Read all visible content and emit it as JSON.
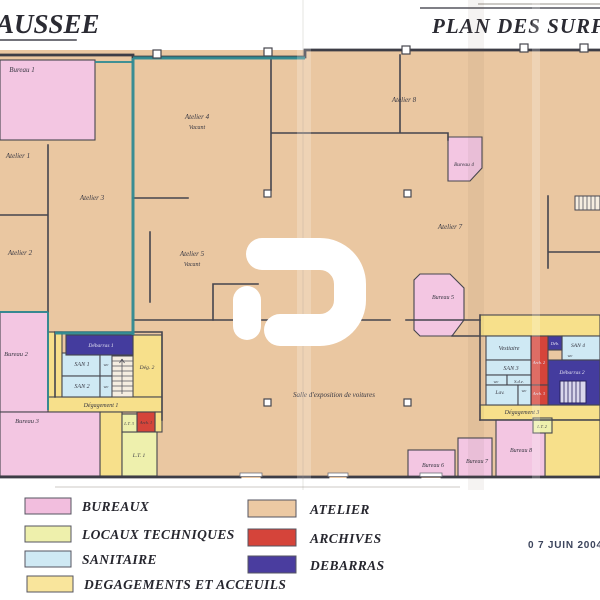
{
  "header": {
    "title_left": "AUSSEE",
    "title_right": "PLAN DES SURFAC"
  },
  "stamp": {
    "date": "0 7 JUIN 2004"
  },
  "legend": {
    "left": [
      {
        "label": "BUREAUX",
        "color": "#f2bede"
      },
      {
        "label": "LOCAUX TECHNIQUES",
        "color": "#eef0ac"
      },
      {
        "label": "SANITAIRE",
        "color": "#cfe9f4"
      },
      {
        "label": "DEGAGEMENTS ET ACCEUILS",
        "color": "#f9e59c"
      }
    ],
    "right": [
      {
        "label": "ATELIER",
        "color": "#ecc9a3"
      },
      {
        "label": "ARCHIVES",
        "color": "#d5443a"
      },
      {
        "label": "DEBARRAS",
        "color": "#4a3d9f"
      }
    ]
  },
  "rooms": {
    "bureau_1": "Bureau 1",
    "bureau_2": "Bureau 2",
    "bureau_3": "Bureau 3",
    "bureau_4": "Bureau 4",
    "bureau_5": "Bureau 5",
    "bureau_6": "Bureau 6",
    "bureau_7": "Bureau 7",
    "bureau_8": "Bureau 8",
    "atelier_1": "Atelier 1",
    "atelier_2": "Atelier 2",
    "atelier_3": "Atelier 3",
    "atelier_4": "Atelier 4",
    "atelier_5": "Atelier 5",
    "atelier_7": "Atelier 7",
    "atelier_8": "Atelier 8",
    "vacant": "Vacant",
    "salle_expo": "Salle d'exposition de voitures",
    "debarras_1": "Débarras 1",
    "debarras_2": "Débarras 2",
    "deb_abbrev": "Déb.",
    "san_1": "SAN 1",
    "san_2": "SAN 2",
    "san_3": "SAN 3",
    "san_4": "SAN 4",
    "wc": "wc",
    "sde": "S.d.e.",
    "lav": "Lav.",
    "vestiaire": "Vestiaire",
    "degagement_1": "Dégagement 1",
    "deg_2": "Dég. 2",
    "degagement_3": "Dégagement 3",
    "arch_1": "Arch. 1",
    "arch_2": "Arch. 2",
    "arch_3": "Arch. 3",
    "lt_1": "L.T. 1",
    "lt_2": "L.T. 2",
    "lt_3": "L.T. 3"
  },
  "colors": {
    "atelier": "#eac7a1",
    "bureau": "#f3c6e2",
    "sanitaire": "#cfe9f4",
    "degagement": "#f7e08b",
    "local_technique": "#eef0ad",
    "archives": "#d5443a",
    "debarras": "#443c9e",
    "teal_outline": "#2f8a92",
    "wall": "#45454e"
  }
}
